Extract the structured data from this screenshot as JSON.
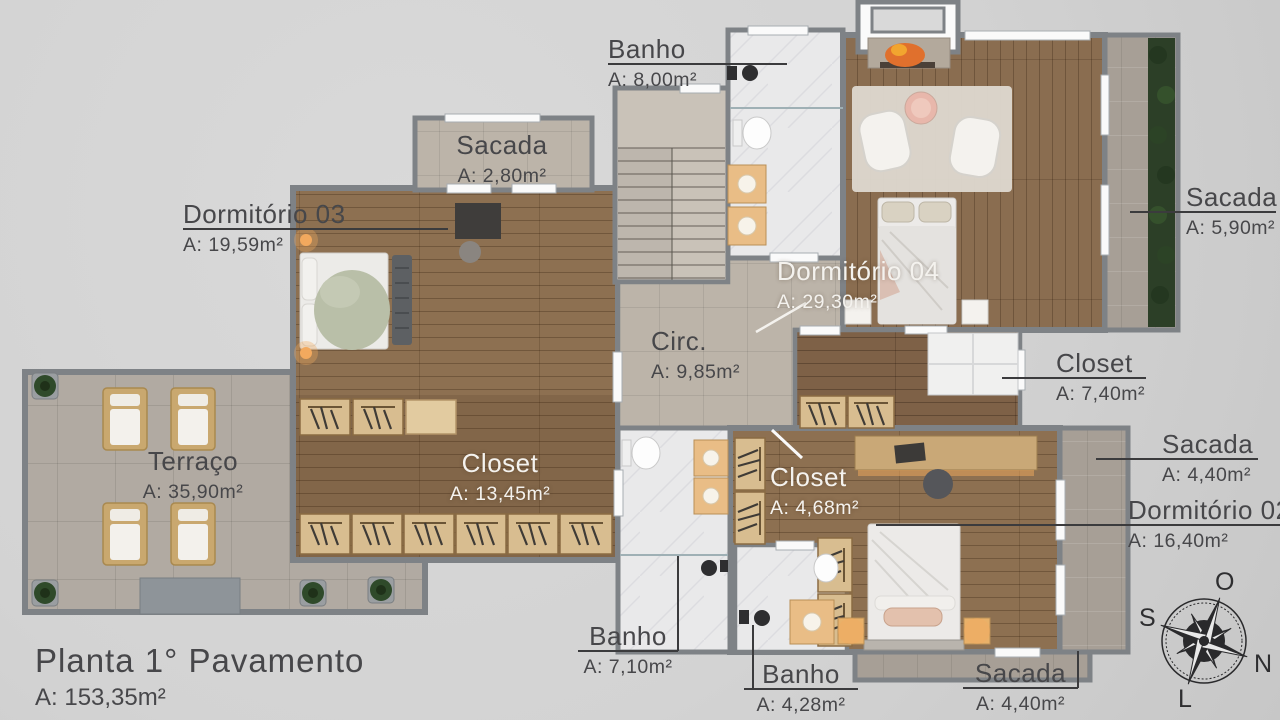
{
  "plan": {
    "title": {
      "name": "Planta 1° Pavamento",
      "area": "A: 153,35m²"
    },
    "rooms": [
      {
        "id": "banho-superior",
        "name": "Banho",
        "area": "A: 8,00m²"
      },
      {
        "id": "sacada-superior",
        "name": "Sacada",
        "area": "A: 2,80m²"
      },
      {
        "id": "dormitorio-03",
        "name": "Dormitório 03",
        "area": "A: 19,59m²"
      },
      {
        "id": "dormitorio-04",
        "name": "Dormitório 04",
        "area": "A: 29,30m²"
      },
      {
        "id": "sacada-direita-superior",
        "name": "Sacada",
        "area": "A: 5,90m²"
      },
      {
        "id": "circulacao",
        "name": "Circ.",
        "area": "A: 9,85m²"
      },
      {
        "id": "closet-dorm04",
        "name": "Closet",
        "area": "A: 7,40m²"
      },
      {
        "id": "terraco",
        "name": "Terraço",
        "area": "A: 35,90m²"
      },
      {
        "id": "closet-dorm03",
        "name": "Closet",
        "area": "A: 13,45m²"
      },
      {
        "id": "closet-dorm02",
        "name": "Closet",
        "area": "A: 4,68m²"
      },
      {
        "id": "sacada-direita-meio",
        "name": "Sacada",
        "area": "A: 4,40m²"
      },
      {
        "id": "dormitorio-02",
        "name": "Dormitório 02",
        "area": "A: 16,40m²"
      },
      {
        "id": "banho-meio",
        "name": "Banho",
        "area": "A: 7,10m²"
      },
      {
        "id": "banho-inferior",
        "name": "Banho",
        "area": "A: 4,28m²"
      },
      {
        "id": "sacada-inferior",
        "name": "Sacada",
        "area": "A: 4,40m²"
      }
    ],
    "compass": {
      "top": "O",
      "left": "S",
      "right": "N",
      "bottom": "L"
    },
    "colors": {
      "background": "#d3d3d3",
      "wall": "#7e8286",
      "wood": "#8d7051",
      "tile": "#bcb4a9",
      "terrace_tile": "#b1aaa2",
      "marble": "#e9e9ea",
      "stone": "#a79f96",
      "hedge": "#2c3f27",
      "label_dark": "#47474a",
      "label_light": "#f4f2ee",
      "fire": "#e0702d",
      "lamp_glow": "#f2a95e"
    }
  }
}
